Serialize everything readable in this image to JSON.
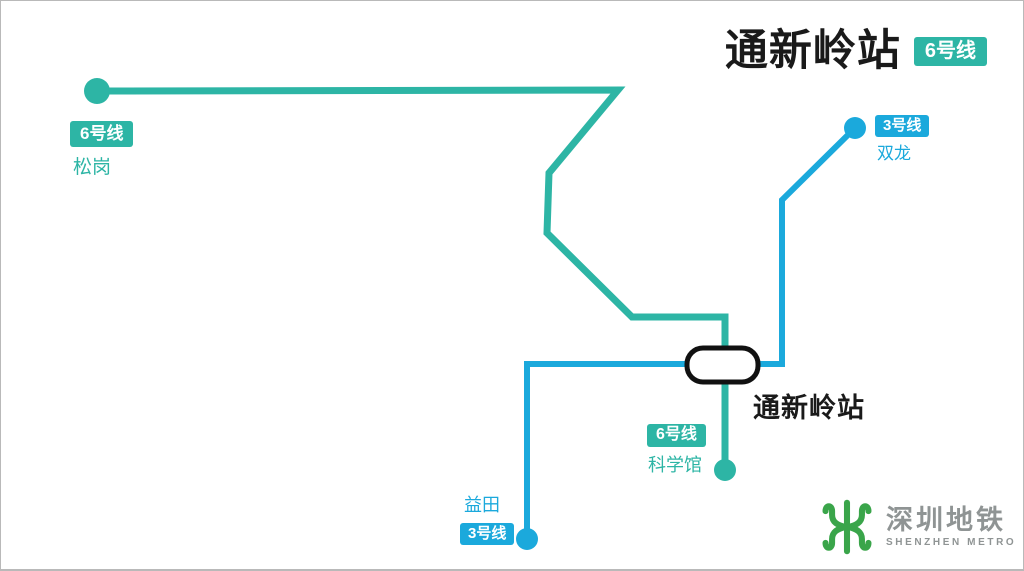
{
  "page": {
    "width": 1024,
    "height": 571,
    "background": "#ffffff",
    "border_color": "#b9b9b9"
  },
  "colors": {
    "line6": "#2db5a5",
    "line3": "#1ba9dc",
    "ink": "#1a1a1a",
    "badge_text": "#ffffff",
    "logo_green": "#3aa54a",
    "logo_gray": "#8f9494",
    "marker_fill": "#ffffff",
    "marker_stroke": "#111111"
  },
  "header": {
    "title": "通新岭站",
    "badge": "6号线"
  },
  "interchange": {
    "label": "通新岭站"
  },
  "termini": {
    "songgang": {
      "badge": "6号线",
      "name": "松岗"
    },
    "shuanglong": {
      "badge": "3号线",
      "name": "双龙"
    },
    "kexueguan": {
      "badge": "6号线",
      "name": "科学馆"
    },
    "yitian": {
      "badge": "3号线",
      "name": "益田"
    }
  },
  "logo": {
    "cn": "深圳地铁",
    "en": "SHENZHEN METRO"
  },
  "map": {
    "line6": {
      "points": "96,90 617,89 548,172 546,232 631,316 724,316 724,469",
      "width": 7
    },
    "line3": {
      "points": "526,538 526,363 781,363 781,199 854,127",
      "width": 6
    },
    "dots": [
      {
        "station": "songgang",
        "line": "line6",
        "cx": 96,
        "cy": 90,
        "r": 13
      },
      {
        "station": "kexueguan",
        "line": "line6",
        "cx": 724,
        "cy": 469,
        "r": 11
      },
      {
        "station": "yitian",
        "line": "line3",
        "cx": 526,
        "cy": 538,
        "r": 11
      },
      {
        "station": "shuanglong",
        "line": "line3",
        "cx": 854,
        "cy": 127,
        "r": 11
      }
    ],
    "marker": {
      "x": 686,
      "y": 347,
      "width": 71,
      "height": 34,
      "rx": 16,
      "stroke_width": 5
    }
  }
}
